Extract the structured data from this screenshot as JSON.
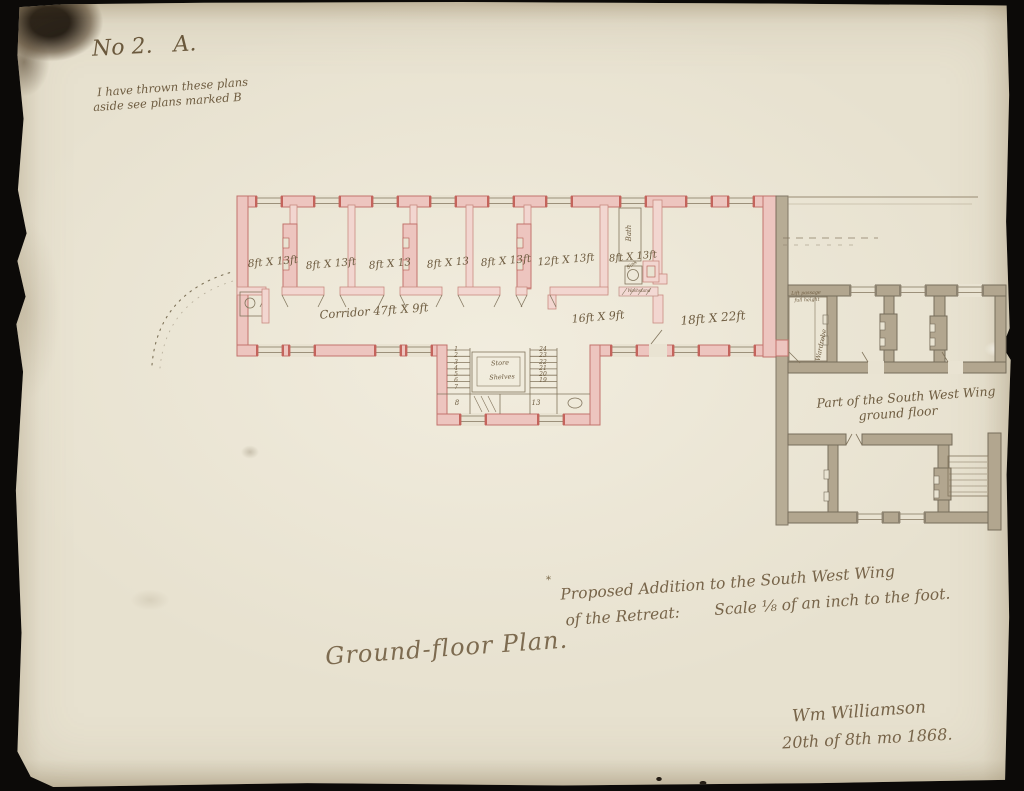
{
  "document": {
    "number_label": "No 2.   A.",
    "note_line1": "I have thrown these plans",
    "note_line2": "aside see plans marked B",
    "title": "Ground-floor Plan.",
    "caption_mark": "*",
    "caption_line1": "Proposed Addition to the South West Wing",
    "caption_line2": "of the Retreat:       Scale ⅛ of an inch to the foot.",
    "signature_name": "Wm Williamson",
    "signature_date": "20th of 8th mo 1868."
  },
  "plan": {
    "room_labels": [
      "8ft X 13ft",
      "8ft X 13ft",
      "8ft X 13",
      "8ft X 13",
      "8ft X 13ft",
      "12ft X 13ft",
      "8ft X 13ft",
      "18ft X 22ft"
    ],
    "corridor_label": "Corridor 47ft X 9ft",
    "lobby_space_label": "16ft X 9ft",
    "bath_label": "Bath",
    "sink_label": "Sink",
    "washstand_label": "Washstand",
    "stair_store_label": "Store",
    "stair_shelves_label": "Shelves",
    "stair_left_numbers": [
      "1",
      "2",
      "3",
      "4",
      "5",
      "6",
      "7"
    ],
    "stair_landing_number": "8",
    "stair_right_numbers": [
      "24",
      "23",
      "22",
      "21",
      "20",
      "19"
    ],
    "stair_lower_number": "13",
    "existing_wing_label_line1": "Part of the South West Wing",
    "existing_wing_label_line2": "ground floor",
    "lift_note_line1": "Lift passage",
    "lift_note_line2": "full height",
    "wardrobe_label": "Wardrobe"
  },
  "colors": {
    "paper": "#e7e1cf",
    "ink": "#6e5c40",
    "new_wall_fill": "#edc5bf",
    "new_wall_stroke": "#c2736c",
    "old_wall_fill": "#b2a68f",
    "old_wall_stroke": "#776d5b",
    "background": "#0c0a08"
  }
}
